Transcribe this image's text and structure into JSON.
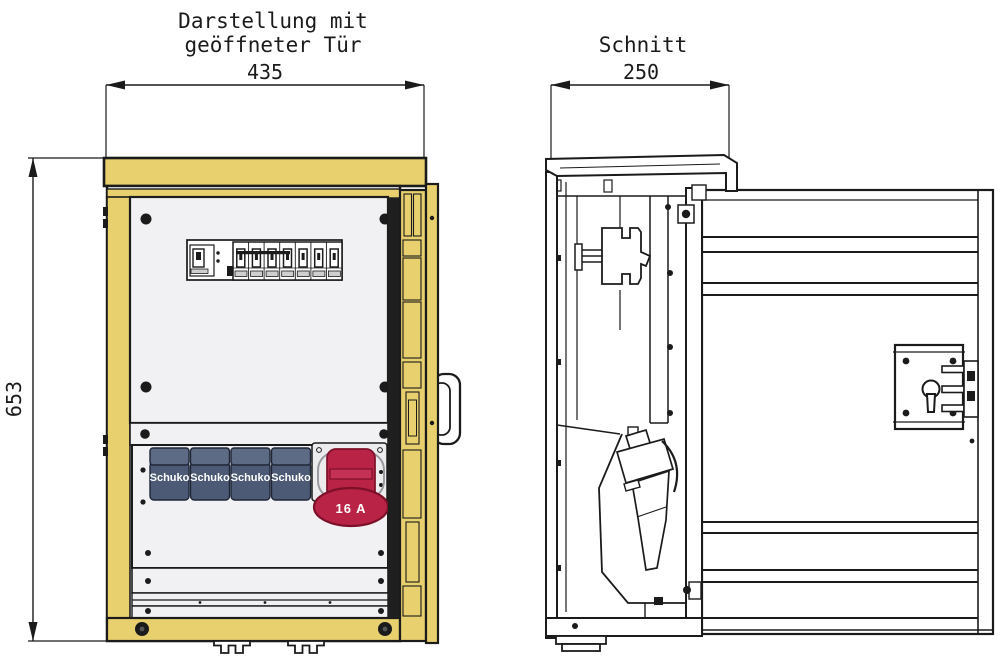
{
  "titles": {
    "left_line1": "Darstellung mit",
    "left_line2": "geöffneter Tür",
    "right": "Schnitt"
  },
  "dimensions": {
    "width_open_door": "435",
    "height": "653",
    "depth_section": "250"
  },
  "labels": {
    "schuko": [
      "Schuko",
      "Schuko",
      "Schuko",
      "Schuko"
    ],
    "cee": "16 A"
  },
  "colors": {
    "line": "#1b1b1b",
    "frame_yellow": "#e8d06f",
    "panel": "#f1f1f4",
    "schuko_body": "#4c5a75",
    "schuko_lid": "#5d6b85",
    "schuko_edge": "#1e2637",
    "cee_red": "#b92346",
    "cee_red_dark": "#7d1029",
    "cee_red_light": "#c53055",
    "tab_gray": "#cfcfcf",
    "plate_gray": "#ececee"
  }
}
